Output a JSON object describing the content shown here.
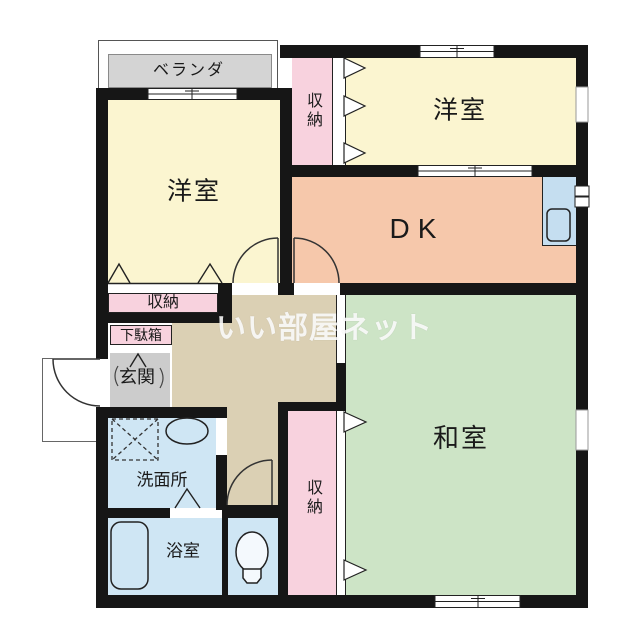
{
  "watermark": {
    "text": "いい部屋ネット"
  },
  "rooms": {
    "veranda": {
      "label": "ベランダ"
    },
    "western_room_1": {
      "label": "洋室"
    },
    "western_room_2": {
      "label": "洋室"
    },
    "dining_kitchen": {
      "label": "DK"
    },
    "japanese_room": {
      "label": "和室"
    },
    "closet_top": {
      "label": "収納"
    },
    "closet_mid": {
      "label": "収納"
    },
    "closet_bottom": {
      "label": "収納"
    },
    "shoe_cabinet": {
      "label": "下駄箱"
    },
    "entrance": {
      "label": "玄関"
    },
    "washroom": {
      "label": "洗面所"
    },
    "bathroom": {
      "label": "浴室"
    }
  },
  "colors": {
    "wall": "#161616",
    "western_room_yellow": "#fbf5d0",
    "closet_pink": "#f8d2de",
    "dk_salmon": "#f6c8ab",
    "japanese_room_green": "#cde4c6",
    "hallway_tan": "#dbd0b4",
    "entrance_gray": "#cccccc",
    "water_blue": "#cfe6f4",
    "kitchen_blue": "#c5def0",
    "veranda_gray": "#d4d4d4"
  },
  "icons": {
    "bathtub": "bathtub-icon",
    "toilet": "toilet-icon",
    "washing_machine_pan": "washing-machine-pan-icon",
    "vanity_basin": "vanity-basin-icon",
    "kitchen_sink": "kitchen-sink-icon",
    "meter_box": "meter-box-icon"
  }
}
